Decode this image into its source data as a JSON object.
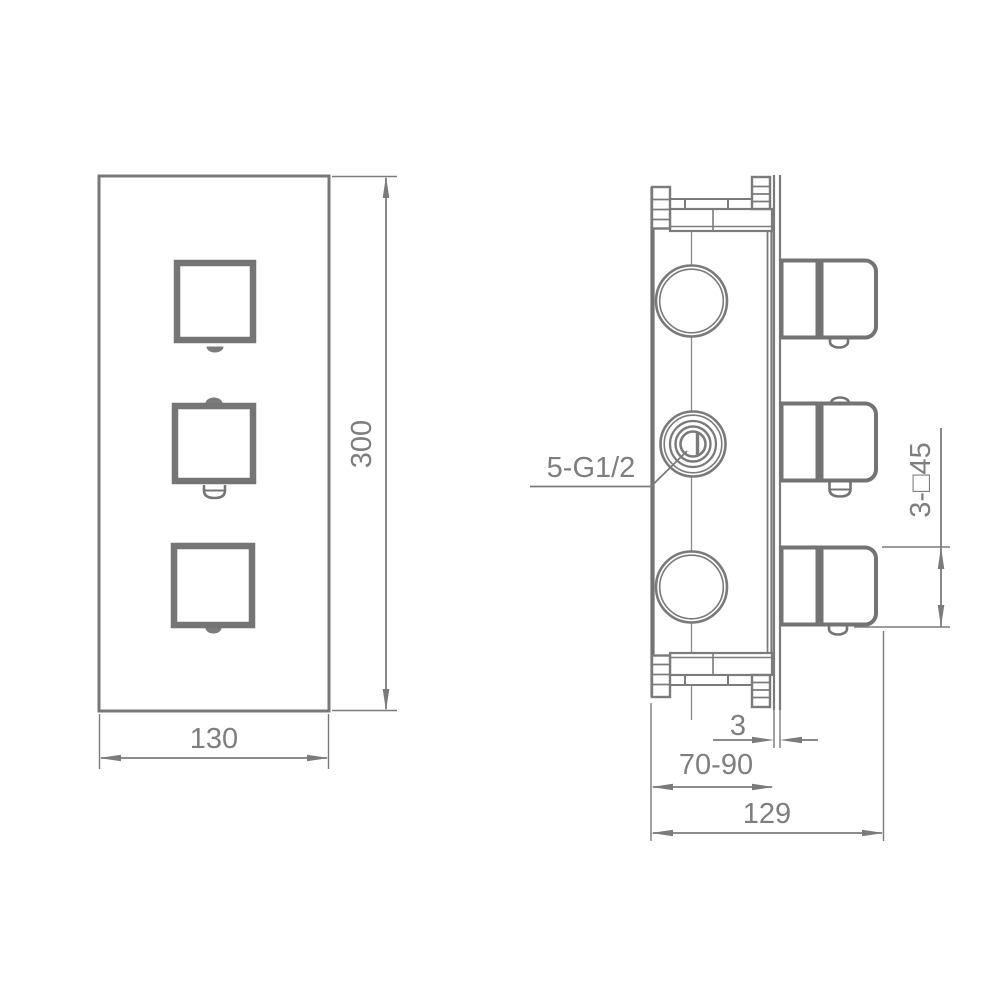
{
  "drawing": {
    "front_view": {
      "width_mm": "130",
      "height_mm": "300"
    },
    "side_view": {
      "ports_label": "5-G1/2",
      "handles_label": "3-□45",
      "plate_thickness_mm": "3",
      "depth_range_mm": "70-90",
      "overall_depth_mm": "129"
    },
    "colors": {
      "line_gray": "#7b7b7b",
      "background": "#ffffff"
    }
  }
}
